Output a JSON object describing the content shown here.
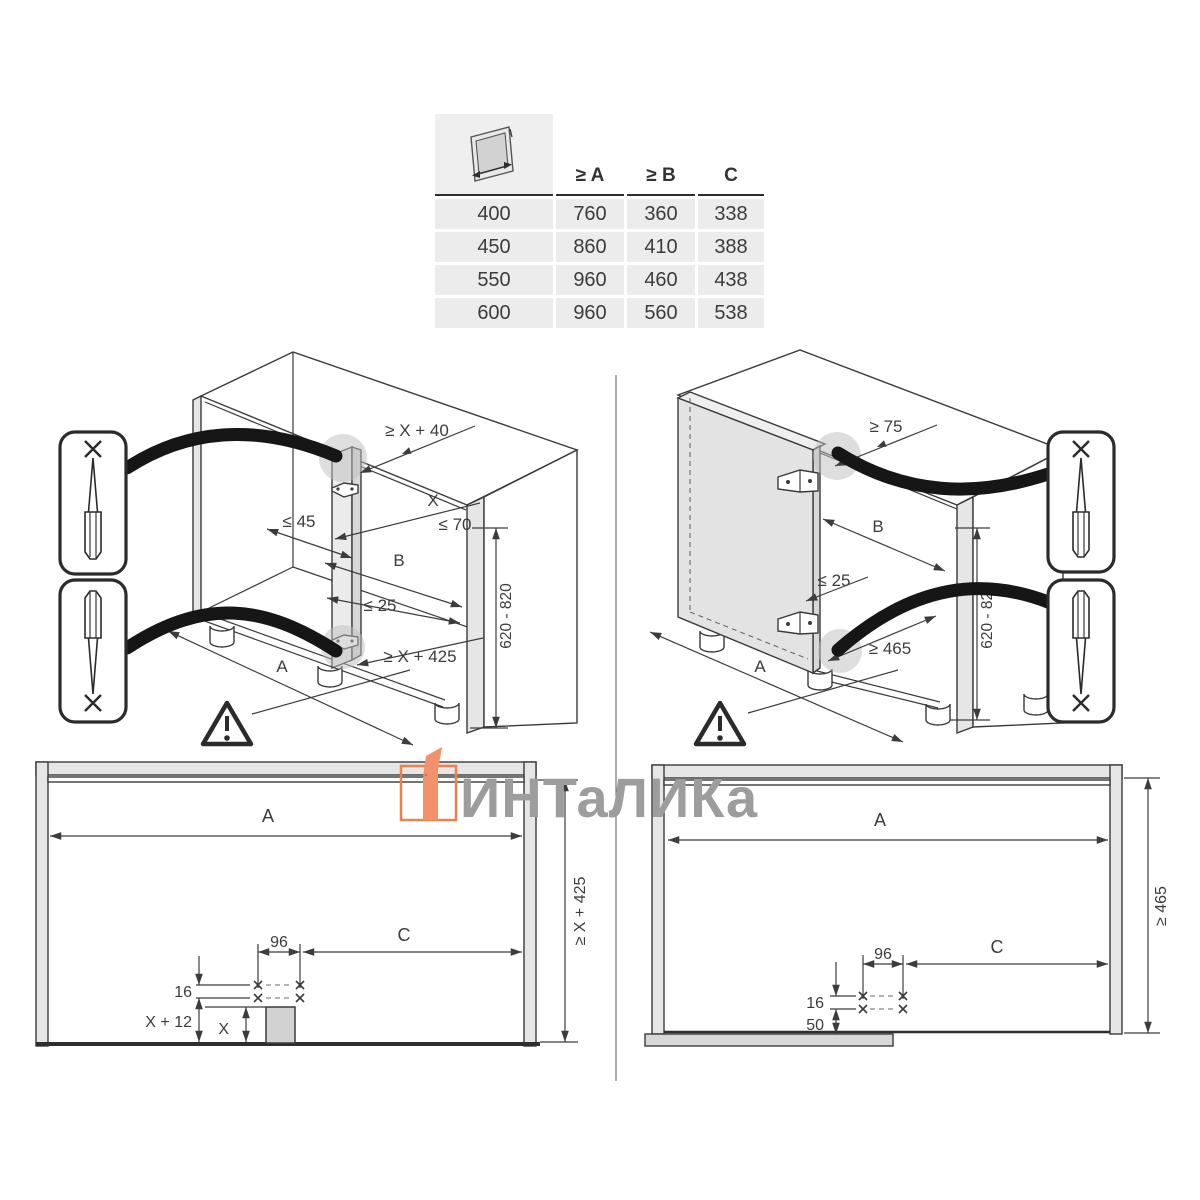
{
  "table": {
    "header": {
      "icon": "door-width-icon",
      "col_a": "≥ A",
      "col_b": "≥ B",
      "col_c": "C"
    },
    "rows": [
      [
        "400",
        "760",
        "360",
        "338"
      ],
      [
        "450",
        "860",
        "410",
        "388"
      ],
      [
        "550",
        "960",
        "460",
        "438"
      ],
      [
        "600",
        "960",
        "560",
        "538"
      ]
    ]
  },
  "left_view": {
    "dim_top": "≥ X + 40",
    "dim_x": "X",
    "dim_70": "≤ 70",
    "dim_45": "≤ 45",
    "dim_b": "B",
    "dim_25": "≤ 25",
    "dim_bottom": "≥ X + 425",
    "dim_a": "A",
    "dim_h": "620 - 820"
  },
  "right_view": {
    "dim_top": "≥ 75",
    "dim_b": "B",
    "dim_25": "≤ 25",
    "dim_bottom": "≥ 465",
    "dim_a": "A",
    "dim_h": "620 - 820"
  },
  "plan_left": {
    "dim_a": "A",
    "dim_right": "≥ X + 425",
    "dim_96": "96",
    "dim_c": "C",
    "dim_16": "16",
    "dim_x12": "X + 12",
    "dim_x": "X"
  },
  "plan_right": {
    "dim_a": "A",
    "dim_right": "≥ 465",
    "dim_96": "96",
    "dim_c": "C",
    "dim_16": "16",
    "dim_50": "50"
  },
  "watermark": {
    "text": "ИНТаЛИКа",
    "logo_color": "#ee7f4f",
    "text_color": "#9d9d9d"
  }
}
